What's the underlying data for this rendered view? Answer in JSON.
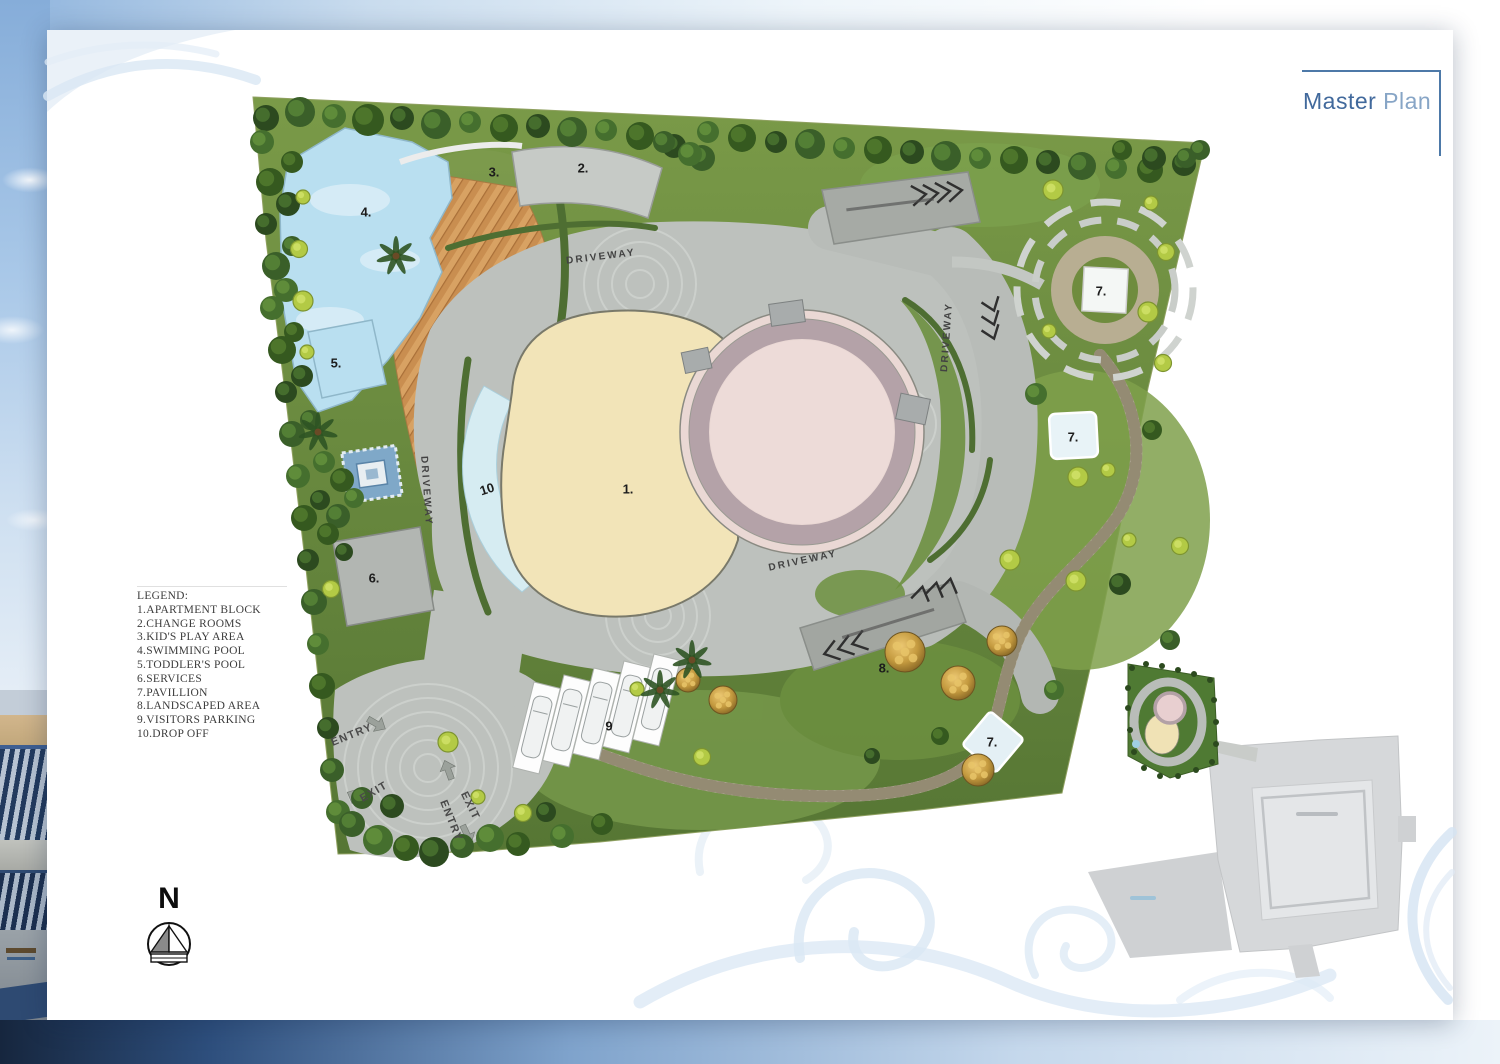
{
  "header": {
    "title_primary": "Master",
    "title_secondary": " Plan"
  },
  "legend": {
    "heading": "LEGEND:",
    "items": [
      "1.APARTMENT BLOCK",
      "2.CHANGE ROOMS",
      "3.KID'S PLAY AREA",
      "4.SWIMMING POOL",
      "5.TODDLER'S POOL",
      "6.SERVICES",
      "7.PAVILLION",
      "8.LANDSCAPED AREA",
      "9.VISITORS PARKING",
      "10.DROP OFF"
    ]
  },
  "compass": {
    "north_label": "N"
  },
  "plan": {
    "driveway_label": "DRIVEWAY",
    "entry_label": "ENTRY",
    "exit_label": "EXIT",
    "markers": {
      "apartment_block": "1.",
      "change_rooms": "2.",
      "kids_play_area": "3.",
      "swimming_pool": "4.",
      "toddlers_pool": "5.",
      "services": "6.",
      "pavilion_top": "7.",
      "pavilion_mid": "7.",
      "pavilion_bottom": "7.",
      "landscaped_area": "8.",
      "visitors_parking": "9",
      "drop_off": "10"
    }
  },
  "colors": {
    "title_blue": "#41699c",
    "title_blue_light": "#87a5c6",
    "accent_border": "#4d79a8",
    "grass_green": "#6f9144",
    "driveway_gray": "#bdc1bd",
    "pool_blue": "#b9dff0",
    "building_cream": "#f2e4b8",
    "building_pink": "#eddbd8"
  }
}
